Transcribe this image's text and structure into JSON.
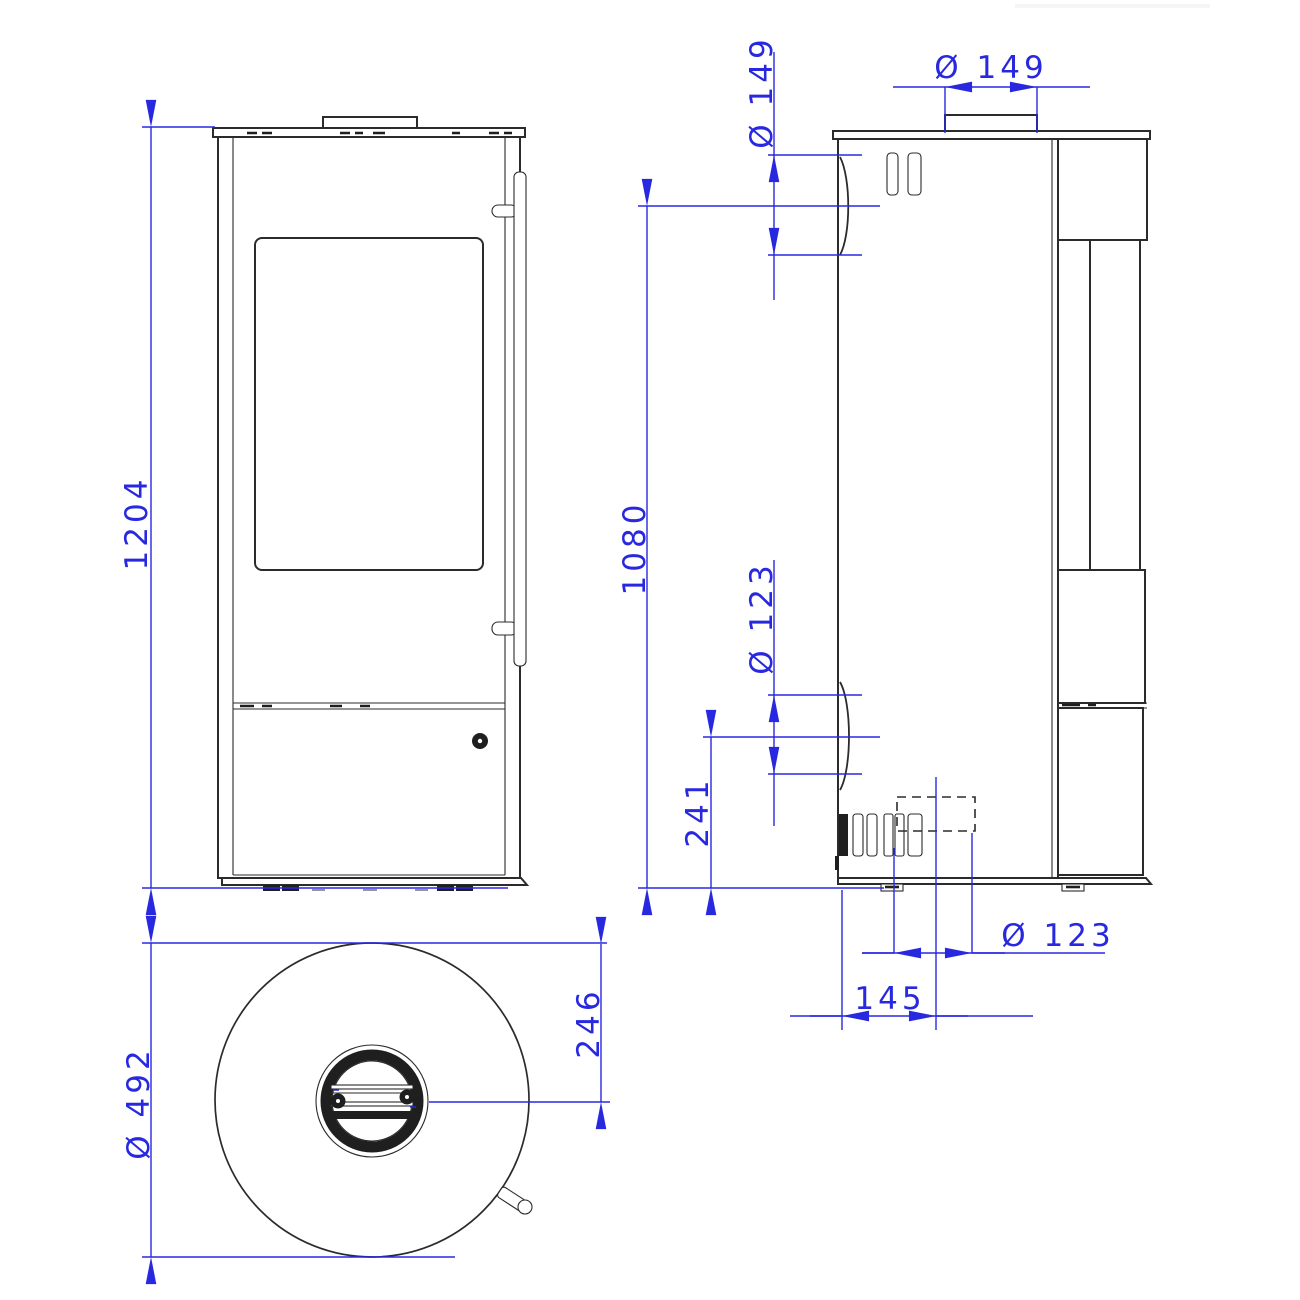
{
  "drawing": {
    "colors": {
      "background": "#ffffff",
      "line": "#2b2b2b",
      "dimension": "#2828e0"
    },
    "dimensions": {
      "front": {
        "height": "1204"
      },
      "side": {
        "flue_diameter_rear": "Ø 149",
        "flue_diameter_top": "Ø 149",
        "flue_center_height": "1080",
        "rear_outlet_diameter": "Ø 123",
        "rear_outlet_center_height": "241",
        "bottom_outlet_diameter": "Ø 123",
        "bottom_outlet_offset": "145"
      },
      "top": {
        "body_diameter": "Ø 492",
        "flue_center_offset": "246"
      }
    }
  }
}
